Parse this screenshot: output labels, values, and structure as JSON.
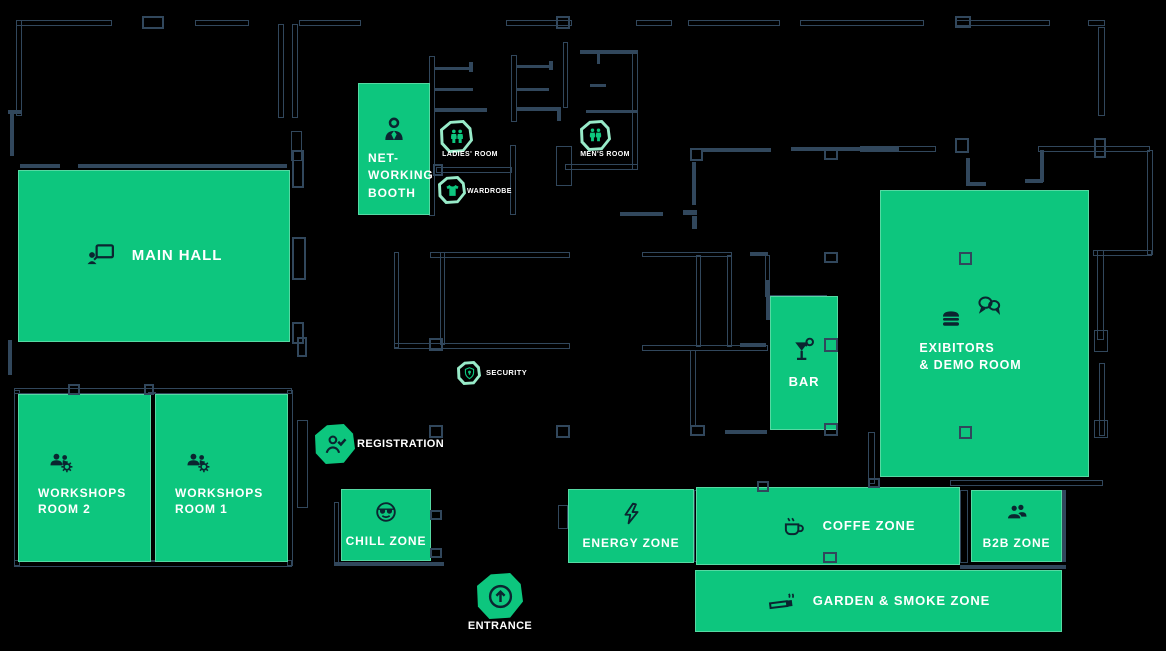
{
  "page": {
    "background": "#000000"
  },
  "palette": {
    "green": "#0dc67e",
    "wall": "#31475c",
    "icon_ink": "#0b2530",
    "mint_outline": "#98ebc9",
    "text": "#ffffff"
  },
  "zones": [
    {
      "id": "main-hall",
      "label": "MAIN HALL",
      "icon": "presentation",
      "x": 18,
      "y": 170,
      "w": 272,
      "h": 172,
      "layout": "row",
      "fs": 15,
      "icon_size": 30
    },
    {
      "id": "networking-booth",
      "label": "NET-\nWORKING\nBOOTH",
      "icon": "person",
      "x": 358,
      "y": 83,
      "w": 72,
      "h": 132,
      "layout": "nw",
      "fs": 12,
      "icon_size": 32
    },
    {
      "id": "workshops-room-2",
      "label": "WORKSHOPS\nROOM 2",
      "icon": "people-gear",
      "x": 18,
      "y": 394,
      "w": 133,
      "h": 168,
      "layout": "ws",
      "fs": 12,
      "icon_size": 27
    },
    {
      "id": "workshops-room-1",
      "label": "WORKSHOPS\nROOM 1",
      "icon": "people-gear",
      "x": 155,
      "y": 394,
      "w": 133,
      "h": 168,
      "layout": "ws",
      "fs": 12,
      "icon_size": 27
    },
    {
      "id": "chill-zone",
      "label": "CHILL ZONE",
      "icon": "cool-face",
      "x": 341,
      "y": 489,
      "w": 90,
      "h": 72,
      "layout": "col",
      "fs": 12,
      "icon_size": 24
    },
    {
      "id": "energy-zone",
      "label": "ENERGY ZONE",
      "icon": "bolt",
      "x": 568,
      "y": 489,
      "w": 126,
      "h": 74,
      "layout": "col",
      "fs": 12,
      "icon_size": 25
    },
    {
      "id": "coffe-zone",
      "label": "COFFE ZONE",
      "icon": "coffee",
      "x": 696,
      "y": 487,
      "w": 264,
      "h": 78,
      "layout": "row",
      "fs": 13,
      "icon_size": 26,
      "pad_left": 40
    },
    {
      "id": "b2b-zone",
      "label": "B2B ZONE",
      "icon": "b2b-people",
      "x": 971,
      "y": 490,
      "w": 91,
      "h": 72,
      "layout": "col",
      "fs": 12,
      "icon_size": 26
    },
    {
      "id": "garden-smoke-zone",
      "label": "GARDEN & SMOKE ZONE",
      "icon": "cigarette",
      "x": 695,
      "y": 570,
      "w": 367,
      "h": 62,
      "layout": "row",
      "fs": 13,
      "icon_size": 30
    },
    {
      "id": "bar",
      "label": "BAR",
      "icon": "cocktail",
      "x": 770,
      "y": 296,
      "w": 68,
      "h": 134,
      "layout": "col",
      "fs": 13,
      "icon_size": 28
    },
    {
      "id": "exibitors-demo-room",
      "label": "EXIBITORS\n& DEMO ROOM",
      "icons": [
        "burger",
        "chat"
      ],
      "x": 880,
      "y": 190,
      "w": 209,
      "h": 287,
      "layout": "ex",
      "fs": 12.5,
      "pad_right": 28
    }
  ],
  "markers": [
    {
      "id": "ladies-room",
      "label": "LADIES' ROOM",
      "icon": "wc-people",
      "style": "outline",
      "x": 440,
      "y": 120,
      "s": 33,
      "label_x": 437,
      "label_y": 151,
      "label_w": 66,
      "align": "center",
      "fs": 7
    },
    {
      "id": "wardrobe",
      "label": "WARDROBE",
      "icon": "tshirt",
      "style": "outline",
      "x": 438,
      "y": 176,
      "s": 28,
      "label_x": 467,
      "label_y": 188,
      "label_w": 60,
      "align": "left",
      "fs": 7
    },
    {
      "id": "mens-room",
      "label": "MEN'S ROOM",
      "icon": "wc-people",
      "style": "outline",
      "x": 580,
      "y": 120,
      "s": 31,
      "label_x": 574,
      "label_y": 151,
      "label_w": 62,
      "align": "center",
      "fs": 7
    },
    {
      "id": "security",
      "label": "SECURITY",
      "icon": "shield",
      "style": "outline",
      "x": 457,
      "y": 361,
      "s": 24,
      "label_x": 486,
      "label_y": 369,
      "label_w": 52,
      "align": "left",
      "fs": 7.5
    },
    {
      "id": "registration",
      "label": "REGISTRATION",
      "icon": "person-check",
      "style": "filled",
      "x": 315,
      "y": 424,
      "s": 40,
      "label_x": 357,
      "label_y": 438,
      "label_w": 110,
      "align": "left",
      "fs": 11
    },
    {
      "id": "entrance",
      "label": "ENTRANCE",
      "icon": "arrow-up",
      "style": "filled",
      "x": 477,
      "y": 573,
      "s": 46,
      "label_x": 462,
      "label_y": 620,
      "label_w": 76,
      "align": "center",
      "fs": 11
    }
  ],
  "floorplan": {
    "walls_outlined": [
      [
        16,
        20,
        96,
        6
      ],
      [
        195,
        20,
        54,
        6
      ],
      [
        299,
        20,
        62,
        6
      ],
      [
        506,
        20,
        66,
        6
      ],
      [
        636,
        20,
        36,
        6
      ],
      [
        688,
        20,
        92,
        6
      ],
      [
        800,
        20,
        124,
        6
      ],
      [
        955,
        20,
        95,
        6
      ],
      [
        1088,
        20,
        17,
        6
      ],
      [
        16,
        20,
        6,
        96
      ],
      [
        278,
        24,
        6,
        94
      ],
      [
        292,
        24,
        6,
        94
      ],
      [
        291,
        131,
        11,
        30
      ],
      [
        429,
        56,
        6,
        160
      ],
      [
        436,
        167,
        76,
        6
      ],
      [
        510,
        145,
        6,
        70
      ],
      [
        511,
        55,
        6,
        67
      ],
      [
        556,
        146,
        16,
        40
      ],
      [
        563,
        42,
        5,
        66
      ],
      [
        632,
        52,
        6,
        118
      ],
      [
        565,
        164,
        73,
        6
      ],
      [
        430,
        252,
        140,
        6
      ],
      [
        394,
        252,
        5,
        96
      ],
      [
        440,
        252,
        5,
        93
      ],
      [
        394,
        343,
        176,
        6
      ],
      [
        14,
        388,
        278,
        6
      ],
      [
        14,
        390,
        6,
        176
      ],
      [
        14,
        560,
        278,
        7
      ],
      [
        148,
        392,
        8,
        170
      ],
      [
        287,
        390,
        6,
        176
      ],
      [
        297,
        420,
        11,
        88
      ],
      [
        334,
        502,
        5,
        62
      ],
      [
        558,
        505,
        10,
        24
      ],
      [
        694,
        490,
        5,
        72
      ],
      [
        960,
        490,
        8,
        73
      ],
      [
        950,
        480,
        153,
        6
      ],
      [
        868,
        432,
        7,
        52
      ],
      [
        1097,
        250,
        7,
        90
      ],
      [
        1099,
        363,
        6,
        73
      ],
      [
        1038,
        146,
        112,
        6
      ],
      [
        1147,
        150,
        6,
        105
      ],
      [
        1093,
        250,
        59,
        6
      ],
      [
        1098,
        27,
        7,
        89
      ],
      [
        860,
        146,
        76,
        6
      ],
      [
        642,
        252,
        90,
        5
      ],
      [
        696,
        255,
        5,
        92
      ],
      [
        727,
        255,
        5,
        92
      ],
      [
        642,
        345,
        126,
        6
      ],
      [
        765,
        255,
        5,
        42
      ],
      [
        770,
        295,
        57,
        5
      ],
      [
        690,
        350,
        6,
        77
      ],
      [
        1094,
        330,
        14,
        22
      ],
      [
        1094,
        420,
        14,
        18
      ]
    ],
    "walls_solid": [
      [
        20,
        164,
        40,
        4
      ],
      [
        78,
        164,
        209,
        4
      ],
      [
        435,
        67,
        38,
        3
      ],
      [
        469,
        62,
        4,
        10
      ],
      [
        435,
        88,
        38,
        3
      ],
      [
        435,
        108,
        52,
        4
      ],
      [
        517,
        65,
        34,
        3
      ],
      [
        549,
        61,
        4,
        9
      ],
      [
        517,
        88,
        32,
        3
      ],
      [
        517,
        107,
        42,
        4
      ],
      [
        557,
        107,
        4,
        14
      ],
      [
        580,
        50,
        58,
        4
      ],
      [
        597,
        54,
        3,
        10
      ],
      [
        590,
        84,
        16,
        3
      ],
      [
        586,
        110,
        52,
        3
      ],
      [
        703,
        148,
        68,
        4
      ],
      [
        791,
        147,
        108,
        4
      ],
      [
        692,
        162,
        4,
        43
      ],
      [
        620,
        212,
        43,
        4
      ],
      [
        683,
        210,
        14,
        5
      ],
      [
        692,
        216,
        5,
        13
      ],
      [
        334,
        562,
        110,
        4
      ],
      [
        740,
        343,
        26,
        4
      ],
      [
        766,
        280,
        4,
        40
      ],
      [
        725,
        430,
        42,
        4
      ],
      [
        8,
        110,
        14,
        4
      ],
      [
        10,
        112,
        4,
        44
      ],
      [
        8,
        340,
        4,
        35
      ],
      [
        1040,
        150,
        4,
        32
      ],
      [
        1025,
        179,
        18,
        4
      ],
      [
        966,
        158,
        4,
        28
      ],
      [
        966,
        182,
        20,
        4
      ],
      [
        1062,
        490,
        4,
        72
      ],
      [
        960,
        565,
        106,
        4
      ],
      [
        750,
        252,
        18,
        4
      ]
    ],
    "columns": [
      [
        142,
        16,
        22,
        13
      ],
      [
        556,
        16,
        14,
        13
      ],
      [
        955,
        16,
        16,
        12
      ],
      [
        68,
        384,
        12,
        11
      ],
      [
        144,
        384,
        10,
        11
      ],
      [
        429,
        338,
        14,
        13
      ],
      [
        429,
        425,
        14,
        13
      ],
      [
        556,
        425,
        14,
        13
      ],
      [
        690,
        148,
        13,
        13
      ],
      [
        824,
        148,
        14,
        12
      ],
      [
        824,
        252,
        14,
        11
      ],
      [
        824,
        338,
        14,
        14
      ],
      [
        824,
        423,
        14,
        13
      ],
      [
        823,
        552,
        14,
        11
      ],
      [
        757,
        481,
        12,
        11
      ],
      [
        868,
        478,
        12,
        10
      ],
      [
        955,
        138,
        14,
        15
      ],
      [
        1094,
        138,
        12,
        20
      ],
      [
        433,
        164,
        10,
        12
      ],
      [
        292,
        150,
        12,
        38
      ],
      [
        292,
        237,
        14,
        43
      ],
      [
        292,
        322,
        12,
        22
      ],
      [
        297,
        337,
        10,
        20
      ],
      [
        690,
        425,
        15,
        11
      ],
      [
        430,
        510,
        12,
        10
      ],
      [
        430,
        548,
        12,
        10
      ]
    ],
    "inner_columns": [
      [
        959,
        252,
        13,
        13
      ],
      [
        959,
        426,
        13,
        13
      ]
    ]
  }
}
